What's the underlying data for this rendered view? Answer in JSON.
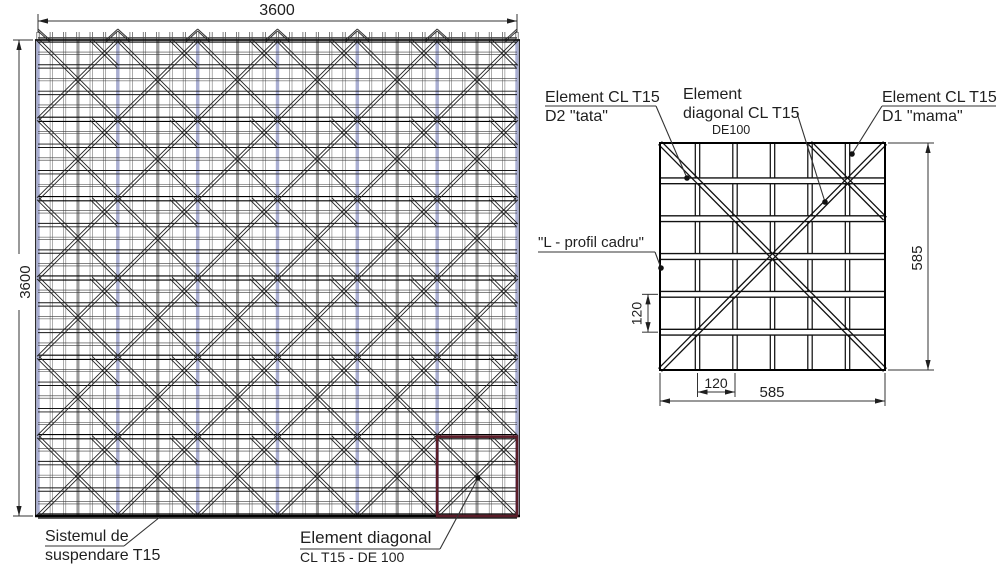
{
  "drawing": {
    "main": {
      "dim_top": "3600",
      "dim_left": "3600",
      "modules_x": 6,
      "modules_y": 6,
      "cells_per_module": 6,
      "label_suspension": {
        "line1": "Sistemul de",
        "line2": "suspendare T15"
      },
      "label_diagonal": {
        "line1": "Element diagonal",
        "line2": "CL T15 - DE 100"
      }
    },
    "detail": {
      "dim_right": "585",
      "dim_bottom": "585",
      "dim_cell_bottom": "120",
      "dim_cell_left": "120",
      "label_d2": {
        "line1": "Element CL T15",
        "line2": "D2 \"tata\""
      },
      "label_diag": {
        "line1": "Element",
        "line2": "diagonal CL T15",
        "line3": "DE100"
      },
      "label_d1": {
        "line1": "Element CL T15",
        "line2": "D1 \"mama\""
      },
      "label_lprofile": "\"L - profil cadru\""
    },
    "pattern": {
      "diag_down_cells": [
        [
          0,
          0
        ],
        [
          1,
          1
        ],
        [
          2,
          2
        ],
        [
          3,
          3
        ],
        [
          4,
          4
        ],
        [
          5,
          5
        ]
      ],
      "diag_up_cells": [
        [
          0,
          5
        ],
        [
          1,
          4
        ],
        [
          2,
          3
        ],
        [
          3,
          2
        ]
      ],
      "cross_block": {
        "col_start": 4,
        "col_end": 6,
        "row_start": 0,
        "row_end": 2
      }
    },
    "colors": {
      "line": "#1f1f1f",
      "line_soft": "#555555",
      "fine_v": "#6a6a6a",
      "fine_h": "#3a3a3a",
      "suspension_main": "#a9aed2",
      "suspension_secondary": "#9b9b9b",
      "highlight": "#5a1c28",
      "dot": "#111111",
      "background": "#ffffff"
    }
  }
}
